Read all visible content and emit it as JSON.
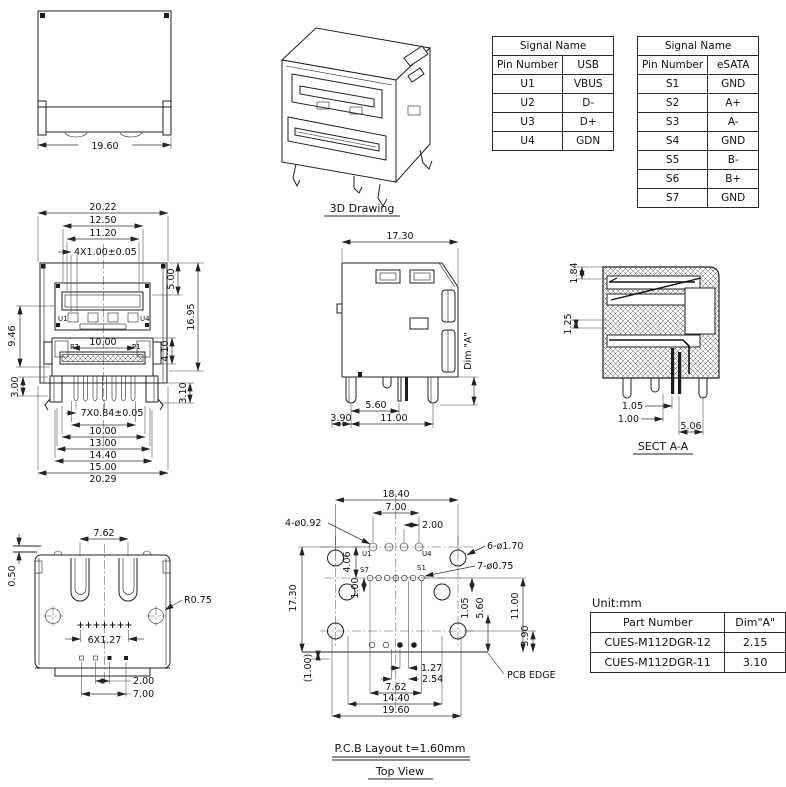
{
  "meta": {
    "bg": "#ffffff",
    "line_color": "#222222"
  },
  "top_view": {
    "width": "19.60"
  },
  "drawing_3d": {
    "label": "3D Drawing"
  },
  "tables": {
    "usb": {
      "title": "Signal Name",
      "col_pin": "Pin Number",
      "col_sig": "USB",
      "rows": [
        {
          "pin": "U1",
          "sig": "VBUS"
        },
        {
          "pin": "U2",
          "sig": "D-"
        },
        {
          "pin": "U3",
          "sig": "D+"
        },
        {
          "pin": "U4",
          "sig": "GDN"
        }
      ]
    },
    "esata": {
      "title": "Signal Name",
      "col_pin": "Pin Number",
      "col_sig": "eSATA",
      "rows": [
        {
          "pin": "S1",
          "sig": "GND"
        },
        {
          "pin": "S2",
          "sig": "A+"
        },
        {
          "pin": "S3",
          "sig": "A-"
        },
        {
          "pin": "S4",
          "sig": "GND"
        },
        {
          "pin": "S5",
          "sig": "B-"
        },
        {
          "pin": "S6",
          "sig": "B+"
        },
        {
          "pin": "S7",
          "sig": "GND"
        }
      ]
    }
  },
  "front_view": {
    "top1": "20.22",
    "top2": "12.50",
    "top3": "11.20",
    "top4": "4X1.00±0.05",
    "left1": "9.46",
    "left2": "3.00",
    "right1": "5.00",
    "right2": "16.95",
    "right3": "4.10",
    "right4": "3.10",
    "mid": "10.00",
    "bot1": "7X0.84±0.05",
    "bot2": "10.00",
    "bot3": "13.00",
    "bot4": "14.40",
    "bot5": "15.00",
    "bot6": "20.29",
    "u1": "U1",
    "u4": "U4",
    "p7": "P7",
    "p1": "P1"
  },
  "side_view": {
    "top": "17.30",
    "dim_a": "Dim \"A\"",
    "b1": "3.90",
    "b2": "5.60",
    "b3": "11.00"
  },
  "sect_view": {
    "label": "SECT A-A",
    "l1": "1.84",
    "l2": "1.25",
    "b1": "1.05",
    "b2": "1.00",
    "b3": "5.06"
  },
  "rear_view": {
    "top": "7.62",
    "left": "0.50",
    "radius": "R0.75",
    "pitch": "6X1.27",
    "b1": "2.00",
    "b2": "7.00"
  },
  "pcb": {
    "w1": "18.40",
    "w2": "7.00",
    "w3": "2.00",
    "holes4": "4-ø0.92",
    "holes6": "6-ø1.70",
    "holes7": "7-ø0.75",
    "left1": "17.30",
    "left2": "(1.00)",
    "v1": "4.06",
    "v2": "1.00",
    "r1": "1.05",
    "r2": "5.60",
    "r3": "11.00",
    "r4": "3.90",
    "b1": "1.27",
    "b2": "2.54",
    "b3": "7.62",
    "b4": "14.40",
    "b5": "19.60",
    "edge": "PCB EDGE",
    "u1": "U1",
    "u4": "U4",
    "s7": "S7",
    "s1": "S1",
    "caption": "P.C.B Layout t=1.60mm",
    "view_label": "Top View"
  },
  "part_table": {
    "unit": "Unit:mm",
    "h1": "Part Number",
    "h2": "Dim\"A\"",
    "rows": [
      {
        "pn": "CUES-M112DGR-12",
        "dim": "2.15"
      },
      {
        "pn": "CUES-M112DGR-11",
        "dim": "3.10"
      }
    ]
  }
}
